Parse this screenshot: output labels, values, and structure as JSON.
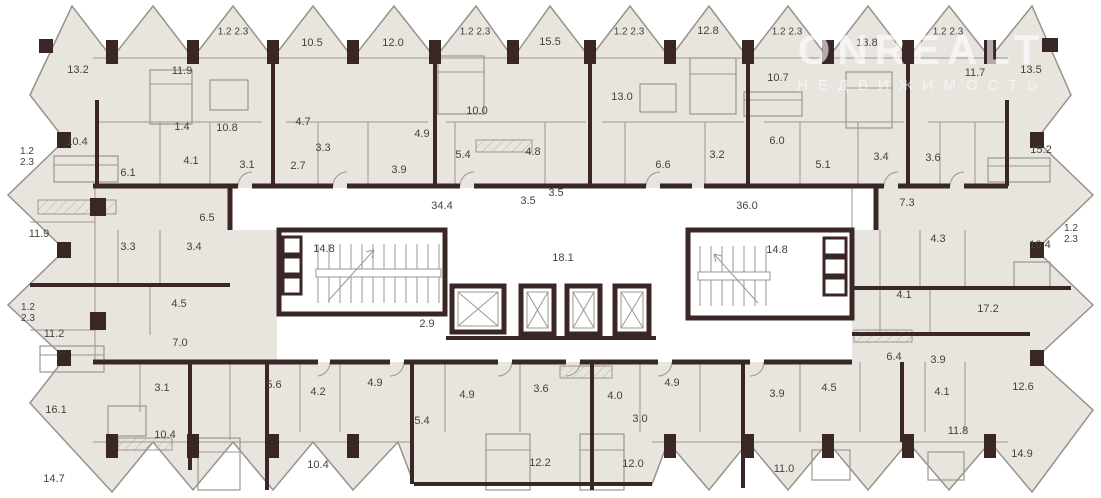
{
  "meta": {
    "type": "residential-floor-plan"
  },
  "watermark": {
    "line1": "ONREALT",
    "line2": "НЕДВИЖИМОСТЬ"
  },
  "colors": {
    "wall": "#3a2725",
    "room_fill": "#e8e5df",
    "corridor_fill": "#ffffff",
    "outline": "#97928b",
    "furniture": "#9b968f",
    "label": "#46413d",
    "background": "#ffffff"
  },
  "area_labels": [
    {
      "t": "13.2",
      "x": 78,
      "y": 70
    },
    {
      "t": "11.9",
      "x": 182,
      "y": 71
    },
    {
      "t": "1.2 2.3",
      "x": 233,
      "y": 32,
      "k": "balcony"
    },
    {
      "t": "10.5",
      "x": 312,
      "y": 43
    },
    {
      "t": "12.0",
      "x": 393,
      "y": 43
    },
    {
      "t": "1.2 2.3",
      "x": 475,
      "y": 32,
      "k": "balcony"
    },
    {
      "t": "15.5",
      "x": 550,
      "y": 42
    },
    {
      "t": "1.2 2.3",
      "x": 629,
      "y": 32,
      "k": "balcony"
    },
    {
      "t": "12.8",
      "x": 708,
      "y": 31
    },
    {
      "t": "1.2 2.3",
      "x": 787,
      "y": 32,
      "k": "balcony"
    },
    {
      "t": "13.8",
      "x": 867,
      "y": 43
    },
    {
      "t": "1.2 2.3",
      "x": 948,
      "y": 32,
      "k": "balcony"
    },
    {
      "t": "13.5",
      "x": 1031,
      "y": 70
    },
    {
      "t": "11.7",
      "x": 975,
      "y": 73
    },
    {
      "t": "10.7",
      "x": 778,
      "y": 78
    },
    {
      "t": "13.0",
      "x": 622,
      "y": 97
    },
    {
      "t": "10.0",
      "x": 477,
      "y": 111
    },
    {
      "t": "1.2\n2.3",
      "x": 27,
      "y": 157,
      "k": "balcony"
    },
    {
      "t": "10.4",
      "x": 77,
      "y": 142
    },
    {
      "t": "1.4",
      "x": 182,
      "y": 127
    },
    {
      "t": "10.8",
      "x": 227,
      "y": 128
    },
    {
      "t": "4.7",
      "x": 303,
      "y": 122
    },
    {
      "t": "4.9",
      "x": 422,
      "y": 134
    },
    {
      "t": "4.8",
      "x": 533,
      "y": 152
    },
    {
      "t": "6.1",
      "x": 128,
      "y": 173
    },
    {
      "t": "4.1",
      "x": 191,
      "y": 161
    },
    {
      "t": "3.1",
      "x": 247,
      "y": 165
    },
    {
      "t": "3.3",
      "x": 323,
      "y": 148
    },
    {
      "t": "2.7",
      "x": 298,
      "y": 166
    },
    {
      "t": "3.9",
      "x": 399,
      "y": 170
    },
    {
      "t": "5.4",
      "x": 463,
      "y": 155
    },
    {
      "t": "3.5",
      "x": 528,
      "y": 201
    },
    {
      "t": "3.5",
      "x": 556,
      "y": 193
    },
    {
      "t": "6.6",
      "x": 663,
      "y": 165
    },
    {
      "t": "3.2",
      "x": 717,
      "y": 155
    },
    {
      "t": "6.0",
      "x": 777,
      "y": 141
    },
    {
      "t": "5.1",
      "x": 823,
      "y": 165
    },
    {
      "t": "3.4",
      "x": 881,
      "y": 157
    },
    {
      "t": "3.6",
      "x": 933,
      "y": 158
    },
    {
      "t": "15.2",
      "x": 1041,
      "y": 150
    },
    {
      "t": "6.5",
      "x": 207,
      "y": 218
    },
    {
      "t": "34.4",
      "x": 442,
      "y": 206,
      "k": "core"
    },
    {
      "t": "36.0",
      "x": 747,
      "y": 206,
      "k": "core"
    },
    {
      "t": "14.8",
      "x": 324,
      "y": 249,
      "k": "core"
    },
    {
      "t": "18.1",
      "x": 563,
      "y": 258,
      "k": "core"
    },
    {
      "t": "14.8",
      "x": 777,
      "y": 250,
      "k": "core"
    },
    {
      "t": "2.9",
      "x": 427,
      "y": 324,
      "k": "core"
    },
    {
      "t": "11.9",
      "x": 39,
      "y": 234
    },
    {
      "t": "3.3",
      "x": 128,
      "y": 247
    },
    {
      "t": "3.4",
      "x": 194,
      "y": 247
    },
    {
      "t": "4.5",
      "x": 179,
      "y": 304
    },
    {
      "t": "7.3",
      "x": 907,
      "y": 203
    },
    {
      "t": "4.3",
      "x": 938,
      "y": 239
    },
    {
      "t": "10.4",
      "x": 1040,
      "y": 245
    },
    {
      "t": "1.2\n2.3",
      "x": 1071,
      "y": 234,
      "k": "balcony"
    },
    {
      "t": "1.2\n2.3",
      "x": 28,
      "y": 313,
      "k": "balcony"
    },
    {
      "t": "11.2",
      "x": 54,
      "y": 334
    },
    {
      "t": "7.0",
      "x": 180,
      "y": 343
    },
    {
      "t": "4.1",
      "x": 904,
      "y": 295
    },
    {
      "t": "17.2",
      "x": 988,
      "y": 309
    },
    {
      "t": "3.1",
      "x": 162,
      "y": 388
    },
    {
      "t": "16.1",
      "x": 56,
      "y": 410
    },
    {
      "t": "10.4",
      "x": 165,
      "y": 435
    },
    {
      "t": "14.7",
      "x": 54,
      "y": 479
    },
    {
      "t": "5.6",
      "x": 274,
      "y": 385
    },
    {
      "t": "4.2",
      "x": 318,
      "y": 392
    },
    {
      "t": "4.9",
      "x": 375,
      "y": 383
    },
    {
      "t": "4.9",
      "x": 467,
      "y": 395
    },
    {
      "t": "3.6",
      "x": 541,
      "y": 389
    },
    {
      "t": "5.4",
      "x": 422,
      "y": 421
    },
    {
      "t": "10.4",
      "x": 318,
      "y": 465
    },
    {
      "t": "12.2",
      "x": 540,
      "y": 463
    },
    {
      "t": "4.0",
      "x": 615,
      "y": 396
    },
    {
      "t": "4.9",
      "x": 672,
      "y": 383
    },
    {
      "t": "3.0",
      "x": 640,
      "y": 419
    },
    {
      "t": "12.0",
      "x": 633,
      "y": 464
    },
    {
      "t": "3.9",
      "x": 777,
      "y": 394
    },
    {
      "t": "4.5",
      "x": 829,
      "y": 388
    },
    {
      "t": "11.0",
      "x": 784,
      "y": 469
    },
    {
      "t": "6.4",
      "x": 894,
      "y": 357
    },
    {
      "t": "3.9",
      "x": 938,
      "y": 360
    },
    {
      "t": "4.1",
      "x": 942,
      "y": 392
    },
    {
      "t": "12.6",
      "x": 1023,
      "y": 387
    },
    {
      "t": "11.8",
      "x": 958,
      "y": 431
    },
    {
      "t": "14.9",
      "x": 1022,
      "y": 454
    }
  ]
}
